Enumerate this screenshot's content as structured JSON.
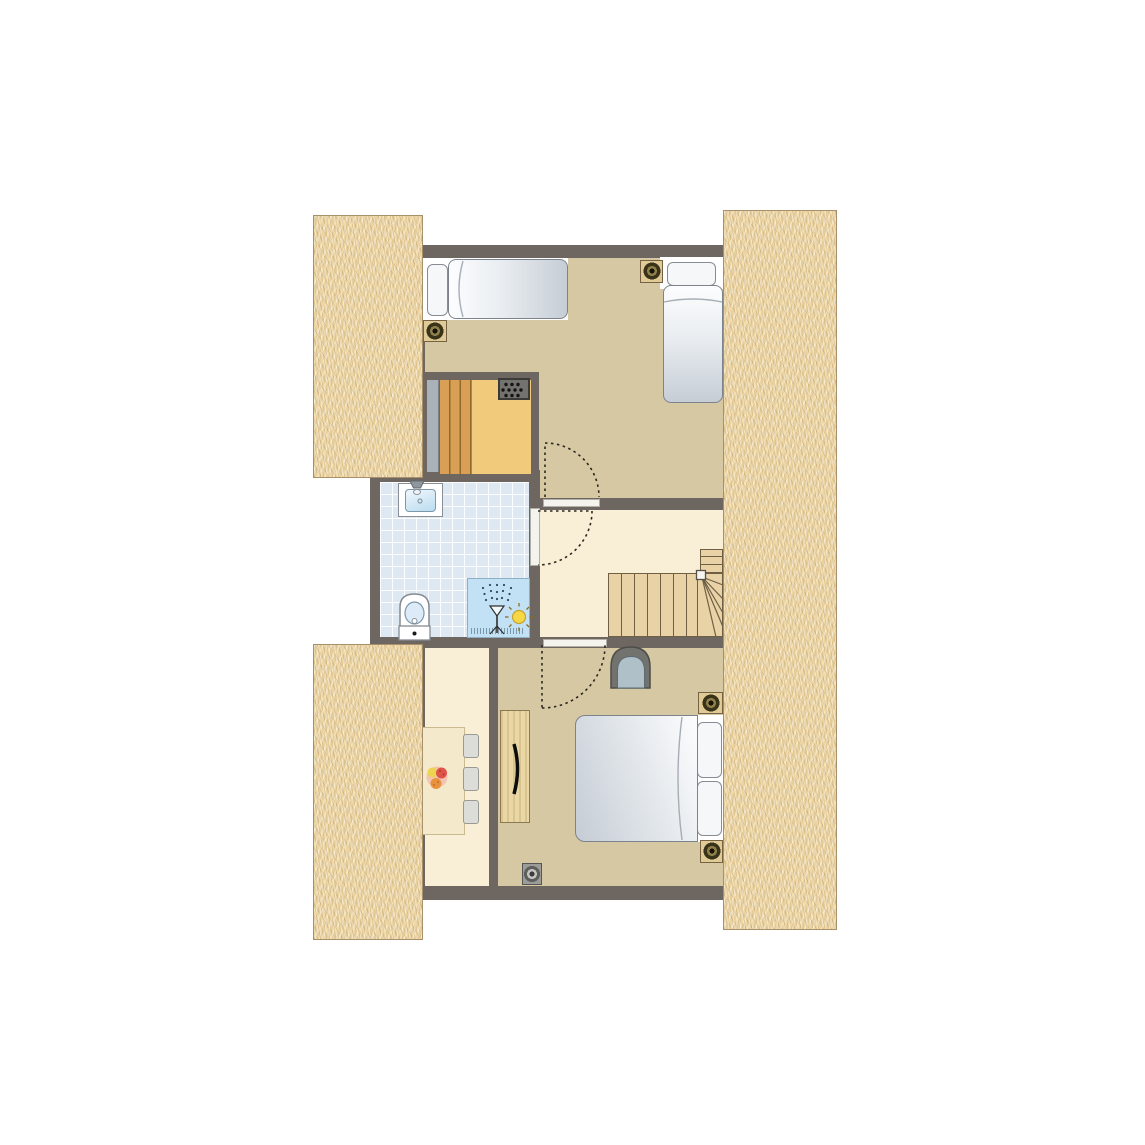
{
  "floor_plan": {
    "kind": "holiday-cottage-upper-floor-plan",
    "rooms": [
      {
        "name": "bedroom-top",
        "floor_color": "#d5c8a2",
        "furniture": [
          "single-bed",
          "single-bed",
          "ceiling-spotlight",
          "ceiling-spotlight"
        ]
      },
      {
        "name": "sauna",
        "floor_color": "#f2ca7b",
        "furniture": [
          "wooden-bench",
          "sauna-heater",
          "glass-door"
        ]
      },
      {
        "name": "bathroom",
        "floor_color": "#dde8f3",
        "furniture": [
          "washbasin",
          "toilet",
          "shower"
        ]
      },
      {
        "name": "landing",
        "floor_color": "#f9efd6",
        "furniture": [
          "staircase-with-winder"
        ]
      },
      {
        "name": "bedroom-bottom",
        "floor_color": "#d5c8a2",
        "furniture": [
          "double-bed",
          "wardrobe",
          "armchair",
          "ceiling-spotlight",
          "ceiling-spotlight",
          "ceiling-spotlight"
        ]
      },
      {
        "name": "dining-area",
        "floor_color": "#f9efd6",
        "furniture": [
          "dining-table",
          "chair",
          "chair",
          "chair",
          "fruit-bowl"
        ]
      }
    ],
    "doors": [
      {
        "name": "door-bedroom-top",
        "style": "dashed-swing-arc"
      },
      {
        "name": "door-bathroom",
        "style": "dashed-swing-arc"
      },
      {
        "name": "door-bedroom-bottom",
        "style": "dashed-swing-arc"
      }
    ],
    "colors": {
      "background": "#ffffff",
      "wall": "#6e6661",
      "thatch_roof": "#ecd5a4",
      "floor_tan": "#d5c8a2",
      "floor_cream": "#f9efd6",
      "tile_blue": "#dde8f3",
      "sauna_yellow": "#f2ca7b",
      "bench_wood": "#d9a055",
      "stair_wood": "#e9d3a6",
      "shower_blue": "#c3e1f4",
      "sun_yellow": "#f6d847",
      "bed_gray": "#c7ced6",
      "armchair_seat": "#b0c0c9",
      "armchair_shell": "#72726e"
    }
  }
}
